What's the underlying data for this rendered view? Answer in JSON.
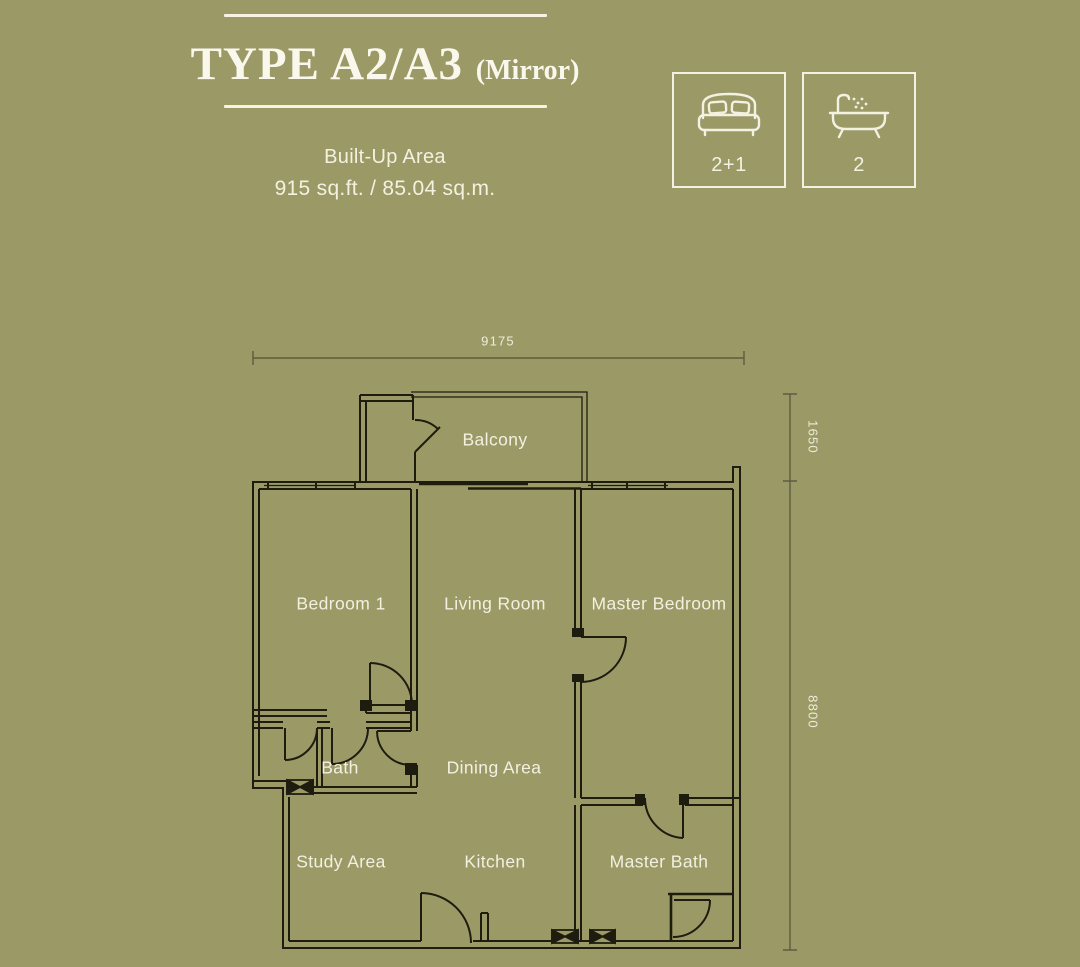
{
  "page": {
    "background_color": "#9b9a67",
    "wall_line_color": "#1e1c0e",
    "dim_line_color": "#5d5c42",
    "text_color": "#f2f0e0"
  },
  "header": {
    "title": "TYPE A2/A3",
    "title_suffix": "(Mirror)",
    "subtitle_line1": "Built-Up Area",
    "subtitle_line2": "915 sq.ft. / 85.04 sq.m."
  },
  "spec_badges": [
    {
      "icon": "bed-icon",
      "value": "2+1"
    },
    {
      "icon": "bathtub-icon",
      "value": "2"
    }
  ],
  "floor_plan": {
    "rooms": [
      {
        "name": "balcony",
        "label": "Balcony"
      },
      {
        "name": "bedroom-1",
        "label": "Bedroom 1"
      },
      {
        "name": "living-room",
        "label": "Living Room"
      },
      {
        "name": "master-bedroom",
        "label": "Master Bedroom"
      },
      {
        "name": "bath",
        "label": "Bath"
      },
      {
        "name": "dining-area",
        "label": "Dining Area"
      },
      {
        "name": "study-area",
        "label": "Study Area"
      },
      {
        "name": "kitchen",
        "label": "Kitchen"
      },
      {
        "name": "master-bath",
        "label": "Master Bath"
      }
    ],
    "dimensions": {
      "overall_width": "9175",
      "balcony_depth": "1650",
      "unit_depth": "8800"
    }
  }
}
